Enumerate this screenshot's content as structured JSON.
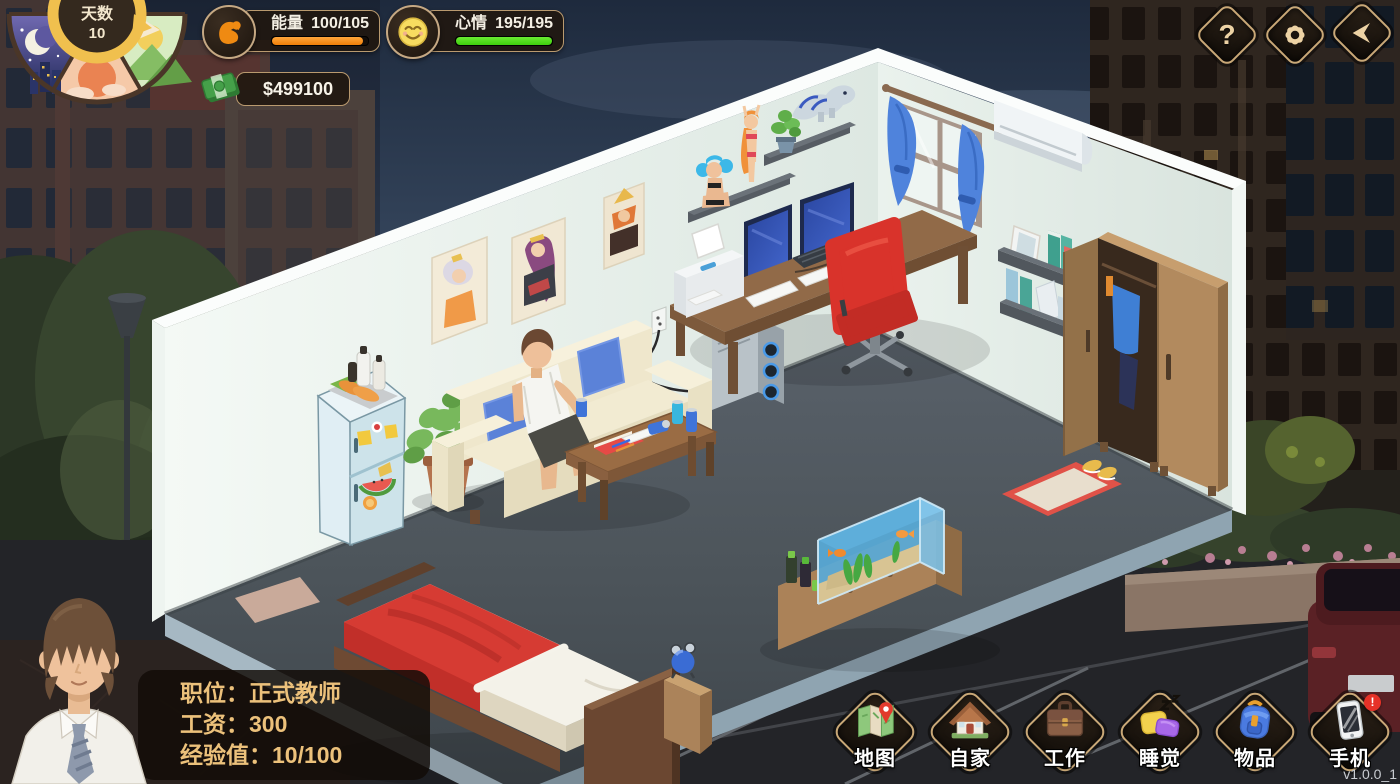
{
  "app": {
    "version": "v1.0.0_1"
  },
  "hud": {
    "day_dial": {
      "label": "天数",
      "value": "10",
      "pointer": "day-segment"
    },
    "energy": {
      "label": "能量",
      "value": "100/105",
      "percent": 95,
      "bar_color": "#ef7f08",
      "icon": "muscle-arm-icon"
    },
    "mood": {
      "label": "心情",
      "value": "195/195",
      "percent": 100,
      "bar_color": "#3ecf0e",
      "icon": "smiley-face-icon"
    },
    "money": {
      "value": "$499100",
      "icon": "cash-icon"
    }
  },
  "top_buttons": {
    "items": [
      {
        "id": "help",
        "icon": "question-mark-icon",
        "glyph": "?"
      },
      {
        "id": "settings",
        "icon": "gear-icon"
      },
      {
        "id": "back",
        "icon": "back-arrow-icon"
      }
    ]
  },
  "player": {
    "portrait": "young-man-brown-hair-white-shirt-tie",
    "lines": [
      "职位：正式教师",
      "工资：300",
      "经验值：10/100"
    ]
  },
  "nav": {
    "items": [
      {
        "id": "map",
        "label": "地图",
        "icon": "map-pin-icon"
      },
      {
        "id": "home",
        "label": "自家",
        "icon": "house-icon"
      },
      {
        "id": "work",
        "label": "工作",
        "icon": "briefcase-icon"
      },
      {
        "id": "sleep",
        "label": "睡觉",
        "icon": "pillow-zz-icon"
      },
      {
        "id": "items",
        "label": "物品",
        "icon": "backpack-icon"
      },
      {
        "id": "phone",
        "label": "手机",
        "icon": "phone-icon",
        "badge": "!"
      }
    ]
  },
  "room": {
    "objects": [
      "bed",
      "nightstand",
      "alarm-clock",
      "sofa",
      "man-sitting",
      "coffee-table",
      "fridge",
      "potted-plant",
      "desk",
      "dual-monitors",
      "keyboard",
      "printer",
      "pc-tower",
      "red-office-chair",
      "wardrobe",
      "wall-shelves-books",
      "picture-frame",
      "figurine-shelves",
      "anime-figurines",
      "dinosaur-figure",
      "posters",
      "window-blue-curtains",
      "air-conditioner",
      "fish-tank",
      "cabinet",
      "doormat",
      "shoes",
      "wall-outlet"
    ]
  },
  "colors": {
    "wall": "#e6efe9",
    "floor": "#4d555b",
    "accent_border": "#c9a877",
    "energy": "#ef7f08",
    "mood": "#3ecf0e",
    "blanket": "#d63b33",
    "curtain": "#4f83dc"
  }
}
